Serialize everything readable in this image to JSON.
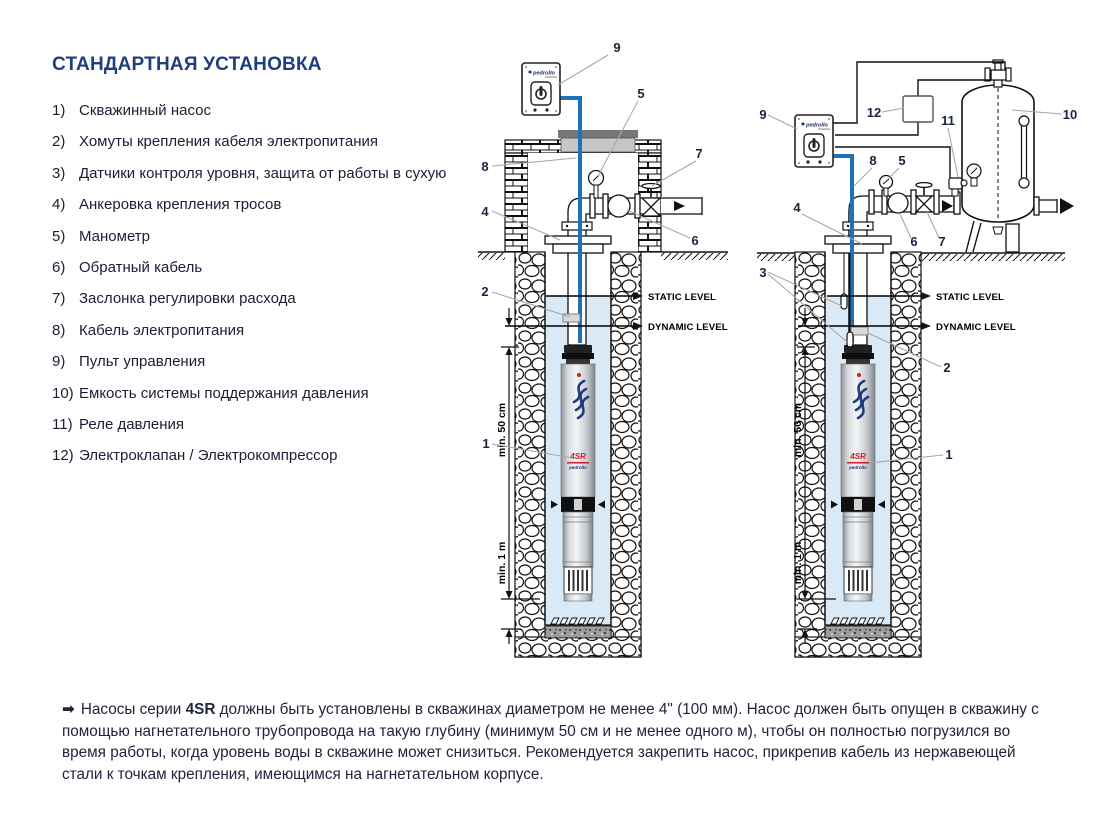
{
  "page": {
    "title": "СТАНДАРТНАЯ УСТАНОВКА"
  },
  "legend": {
    "items": [
      {
        "num": "1)",
        "text": "Скважинный насос"
      },
      {
        "num": "2)",
        "text": "Хомуты крепления кабеля электропитания"
      },
      {
        "num": "3)",
        "text": "Датчики контроля уровня, защита от работы в сухую"
      },
      {
        "num": "4)",
        "text": "Анкеровка крепления тросов"
      },
      {
        "num": "5)",
        "text": "Манометр"
      },
      {
        "num": "6)",
        "text": "Обратный кабель"
      },
      {
        "num": "7)",
        "text": "Заслонка регулировки расхода"
      },
      {
        "num": "8)",
        "text": "Кабель электропитания"
      },
      {
        "num": "9)",
        "text": "Пульт управления"
      },
      {
        "num": "10)",
        "text": "Емкость системы поддержания давления"
      },
      {
        "num": "11)",
        "text": "Реле давления"
      },
      {
        "num": "12)",
        "text": "Электроклапан / Электрокомпрессор"
      }
    ]
  },
  "note": {
    "arrow": "➡",
    "lead": "Насосы серии",
    "bold": "4SR",
    "text": "должны быть установлены в скважинах диаметром не менее 4\" (100 мм). Насос должен быть опущен в скважину с помощью нагнетательного трубопровода на такую глубину (минимум 50 см и не менее одного м), чтобы он полностью погрузился во время работы, когда уровень воды в скважине может снизиться. Рекомендуется закрепить насос, прикрепив кабель из нержавеющей стали к точкам крепления, имеющимся на нагнетательном корпусе."
  },
  "diagram": {
    "brand": "pedrollo",
    "pump_model": "4SR",
    "labels": {
      "static_level": "STATIC LEVEL",
      "dynamic_level": "DYNAMIC LEVEL",
      "min_50": "min. 50 cm",
      "min_1m": "min. 1 m"
    },
    "left_callouts": {
      "c1": "1",
      "c2": "2",
      "c4": "4",
      "c5": "5",
      "c6": "6",
      "c7": "7",
      "c8": "8",
      "c9": "9"
    },
    "right_callouts": {
      "c1": "1",
      "c2": "2",
      "c3": "3",
      "c4": "4",
      "c5": "5",
      "c6": "6",
      "c7": "7",
      "c8": "8",
      "c9": "9",
      "c10": "10",
      "c11": "11",
      "c12": "12"
    }
  },
  "colors": {
    "accent_blue": "#1f3e7e",
    "cable_blue": "#1e72b8",
    "water_blue": "#d9e9f6",
    "pump_red": "#c8202a",
    "logo_navy": "#23397f"
  }
}
